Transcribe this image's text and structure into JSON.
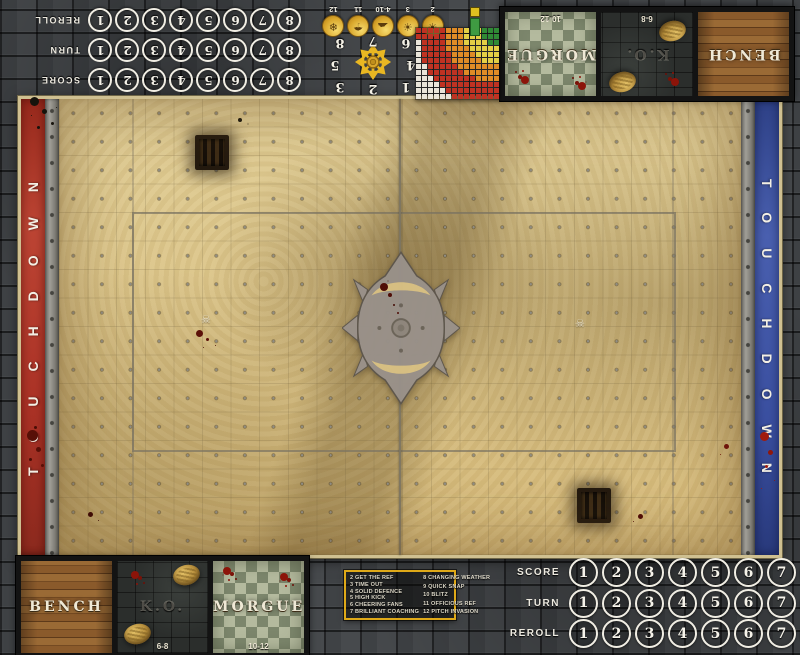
{
  "endzones": {
    "left_label": "TOUCHDOWN",
    "right_label": "TOUCHDOWN",
    "left_color": "#ab3226",
    "right_color": "#3a4fa0"
  },
  "field": {
    "sand_color": "#d8c086",
    "stone_color": "#3f4245",
    "frame_color": "#cfc091"
  },
  "icons": {
    "skull": "☠"
  },
  "tracker": {
    "rows": [
      {
        "label": "SCORE",
        "cells": [
          "1",
          "2",
          "3",
          "4",
          "5",
          "6",
          "7",
          "8"
        ]
      },
      {
        "label": "TURN",
        "cells": [
          "1",
          "2",
          "3",
          "4",
          "5",
          "6",
          "7",
          "8"
        ]
      },
      {
        "label": "REROLL",
        "cells": [
          "1",
          "2",
          "3",
          "4",
          "5",
          "6",
          "7",
          "8"
        ]
      }
    ]
  },
  "dugout": {
    "panels": [
      {
        "id": "bench",
        "label": "BENCH",
        "style": "wood",
        "dice_range": ""
      },
      {
        "id": "ko",
        "label": "K.O.",
        "style": "stone",
        "dice_range": "6-8"
      },
      {
        "id": "morgue",
        "label": "MORGUE",
        "style": "tiles",
        "dice_range": "10-12"
      }
    ]
  },
  "weather_track": {
    "entries": [
      {
        "range": "2",
        "icon": "sun-icon",
        "glyph": "☀"
      },
      {
        "range": "3",
        "icon": "sun-icon",
        "glyph": "☀"
      },
      {
        "range": "4-10",
        "icon": "cloud-icon",
        "glyph": "☁"
      },
      {
        "range": "11",
        "icon": "rain-icon",
        "glyph": "☂"
      },
      {
        "range": "12",
        "icon": "snowflake-icon",
        "glyph": "❄"
      }
    ]
  },
  "scatter_template": {
    "numbers": [
      "1",
      "2",
      "3",
      "4",
      "5",
      "6",
      "7",
      "8"
    ]
  },
  "range_ruler": {
    "cols": 14,
    "rows": 12,
    "bands": [
      {
        "name": "green",
        "color": "#2f8a35",
        "max": 2.3
      },
      {
        "name": "yellow",
        "color": "#e3cf45",
        "max": 5.6
      },
      {
        "name": "orange",
        "color": "#df8b26",
        "max": 8.8
      },
      {
        "name": "red",
        "color": "#bf3222",
        "max": 13.05
      },
      {
        "name": "white",
        "color": "#e9e5da",
        "max": 999
      }
    ]
  },
  "kickoff_table": {
    "left_column": [
      "2 GET THE REF",
      "3 TIME OUT",
      "4 SOLID DEFENCE",
      "5 HIGH KICK",
      "6 CHEERING FANS",
      "7 BRILLIANT COACHING"
    ],
    "right_column": [
      "8 CHANGING WEATHER",
      "9 QUICK SNAP",
      "10 BLITZ",
      "11 OFFICIOUS REF",
      "12 PITCH INVASION"
    ]
  }
}
